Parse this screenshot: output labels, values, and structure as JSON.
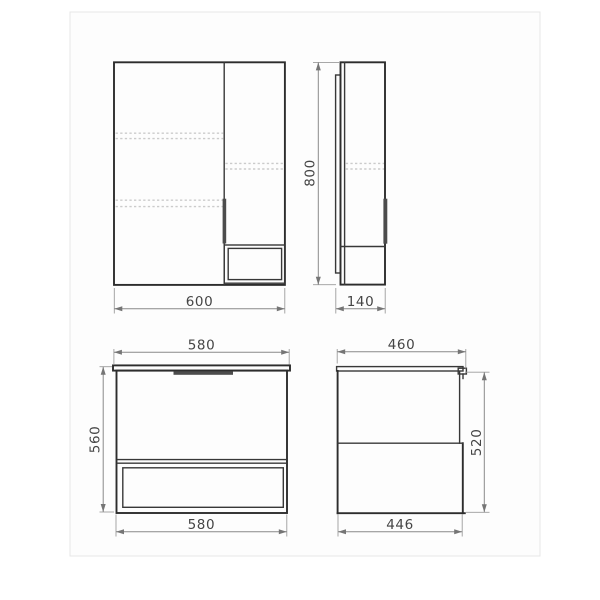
{
  "drawing": {
    "title": "bathroom-furniture-dimension-drawing",
    "colors": {
      "outline": "#2d2d2d",
      "dimension_lines": "#8a8a8a",
      "dimension_text": "#454545",
      "dashed_shelf_lines": "#cbcbcb",
      "handle_fill": "#4c4c4c",
      "background": "#ffffff",
      "sheet_fill": "#fdfdfd"
    },
    "mirror_front": {
      "width": "600"
    },
    "mirror_side": {
      "height": "800",
      "depth": "140"
    },
    "vanity_front": {
      "top_width": "580",
      "height": "560",
      "bottom_width": "580"
    },
    "vanity_side": {
      "top_depth": "460",
      "height": "520",
      "bottom_depth": "446"
    }
  }
}
